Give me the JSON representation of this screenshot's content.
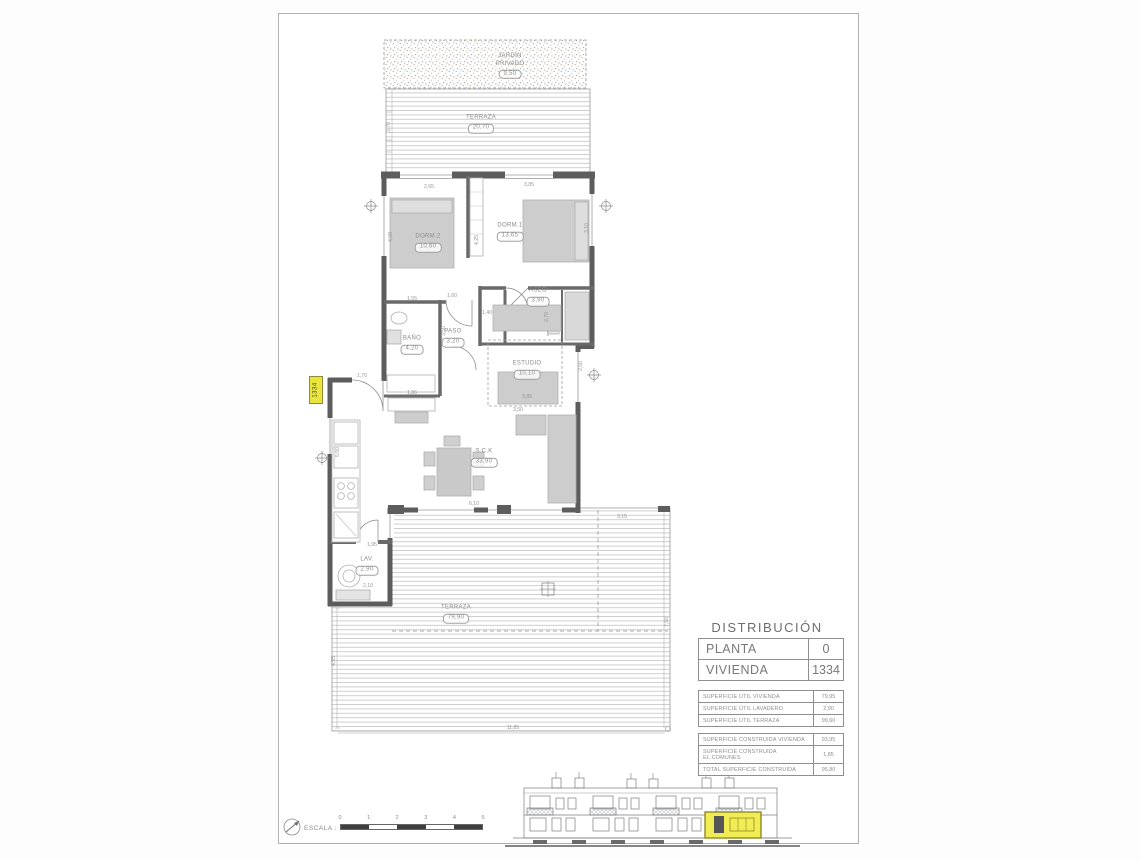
{
  "sheet": {
    "plan": {
      "unit_tag": "1334",
      "rooms": [
        {
          "name": "JARDÍN",
          "name2": "PRIVADO",
          "area": "9,50"
        },
        {
          "name": "TERRAZA",
          "area": "20,70"
        },
        {
          "name": "DORM.2",
          "area": "10,60"
        },
        {
          "name": "DORM.1",
          "area": "13,65"
        },
        {
          "name": "ASEO",
          "area": "3,90"
        },
        {
          "name": "BAÑO",
          "area": "4,20"
        },
        {
          "name": "PASO",
          "area": "3,20"
        },
        {
          "name": "ESTUDIO",
          "area": "10,10"
        },
        {
          "name": "S.C.K",
          "area": "33,90"
        },
        {
          "name": "LAV.",
          "area": "2,90"
        },
        {
          "name": "TERRAZA",
          "area": "79,90"
        }
      ],
      "dimensions": [
        "2,65",
        "3,85",
        "3,10",
        "4,08",
        "4,25",
        "1,00",
        "1,55",
        "2,70",
        "3,50",
        "1,86",
        "3,85",
        "3,50",
        "1,70",
        "5,50",
        "1,95",
        "2,10",
        "6,10",
        "3,15",
        "7,50",
        "11,85",
        "4,55",
        "3,70",
        "2,50",
        "1,40"
      ]
    },
    "distribution": {
      "title": "DISTRIBUCIÓN",
      "info_rows": [
        {
          "label": "PLANTA",
          "value": "0"
        },
        {
          "label": "VIVIENDA",
          "value": "1334"
        }
      ],
      "util_rows": [
        {
          "label": "SUPERFICIE ÚTIL VIVIENDA",
          "value": "79,95"
        },
        {
          "label": "SUPERFICIE ÚTIL LAVADERO",
          "value": "2,90"
        },
        {
          "label": "SUPERFICIE ÚTIL TERRAZA",
          "value": "99,60"
        }
      ],
      "construida_rows": [
        {
          "label": "SUPERFICIE CONSTRUIDA VIVIENDA",
          "value": "93,95"
        },
        {
          "label": "SUPERFICIE CONSTRUIDA EL.COMUNES",
          "value": "1,85"
        },
        {
          "label": "TOTAL SUPERFICIE CONSTRUIDA",
          "value": "95,80"
        }
      ]
    },
    "scale_bar": {
      "label": "ESCALA :",
      "ticks": [
        "0",
        "1",
        "2",
        "3",
        "4",
        "5"
      ]
    }
  }
}
